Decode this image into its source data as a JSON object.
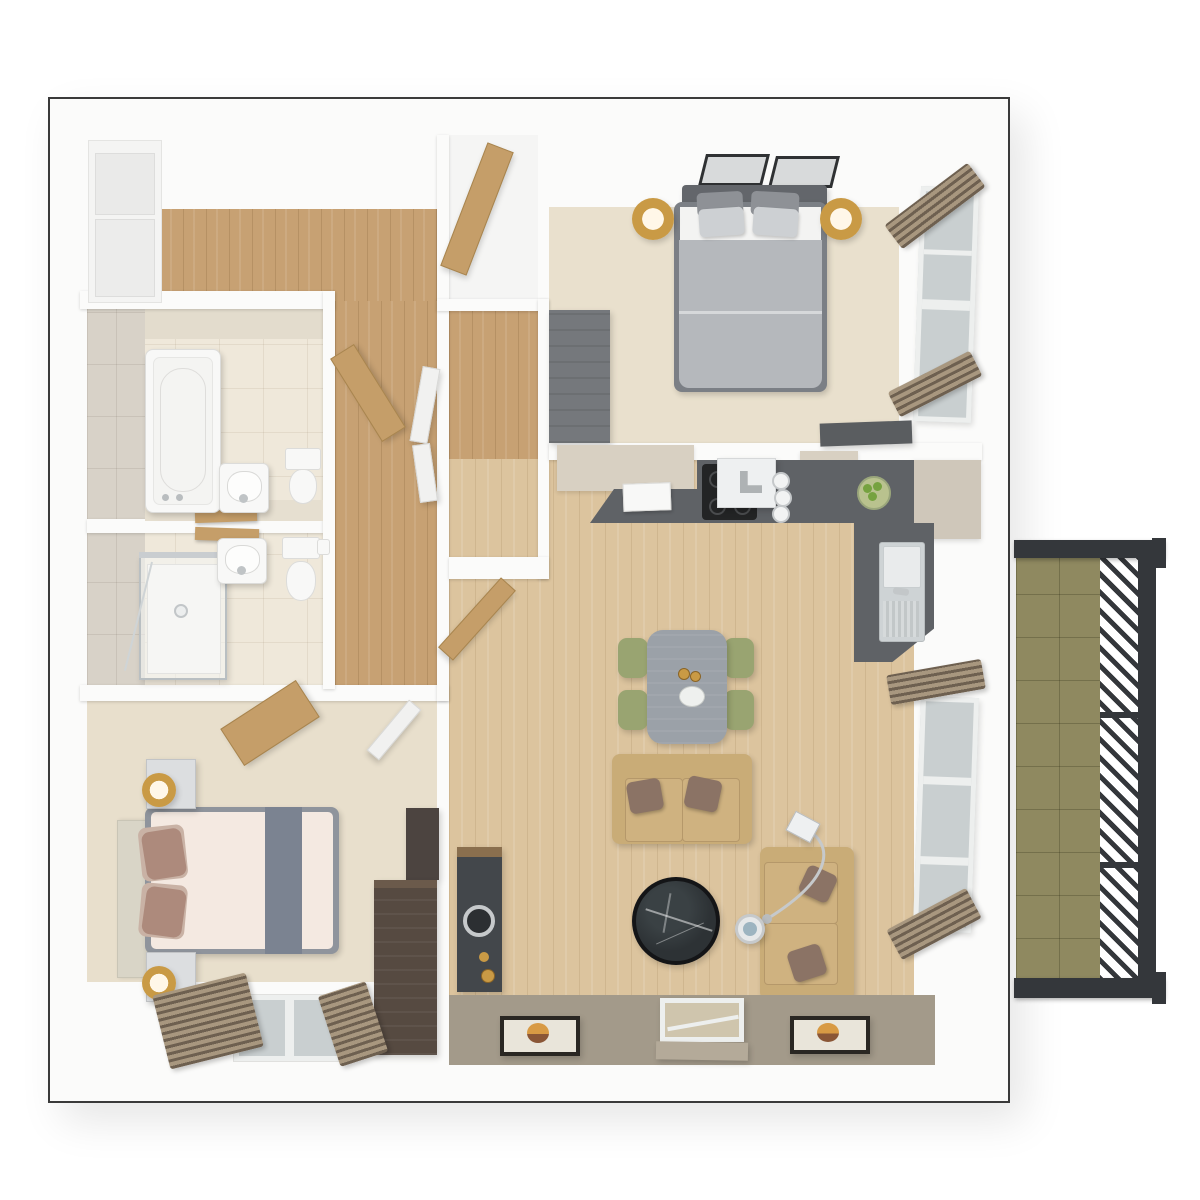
{
  "scene": {
    "type": "architectural-floor-plan-3d-render",
    "view": "top-down-dollhouse",
    "background": "#ffffff",
    "rooms": [
      {
        "id": "entrance-hall",
        "floor": "oak-wood",
        "features": [
          "storage-closet-sliding-doors",
          "internal-doors"
        ]
      },
      {
        "id": "bathroom",
        "floor": "cream-tile",
        "fixtures": [
          "bathtub",
          "washbasin",
          "toilet",
          "wooden-shelf",
          "tiled-wall"
        ]
      },
      {
        "id": "shower-room",
        "floor": "cream-tile",
        "fixtures": [
          "glass-shower-enclosure",
          "washbasin",
          "toilet",
          "wooden-shelf"
        ]
      },
      {
        "id": "bedroom-2",
        "floor": "beige-carpet",
        "furniture": [
          "double-bed-cream-duvet",
          "gray-bed-runner",
          "upholstered-headboard",
          "nightstand-x2",
          "gold-table-lamp-x2",
          "angled-wood-desk",
          "dark-wood-dresser",
          "dark-wood-cabinet",
          "window-pair",
          "louvre-blind-stack-x2",
          "white-door-open"
        ]
      },
      {
        "id": "bedroom-1",
        "floor": "beige-carpet",
        "furniture": [
          "double-bed-gray-duvet",
          "gray-headboard",
          "gray-pillows-x4",
          "gold-floor-lamp-x2",
          "gray-dresser",
          "gray-desk",
          "entry-closet-wood-door",
          "wardrobe-hall",
          "window",
          "louvre-blind-stack-x2",
          "roof-window-x2"
        ]
      },
      {
        "id": "kitchen",
        "furniture": [
          "l-shaped-dark-counter",
          "cream-upper-cabinets",
          "induction-hob",
          "extractor-hood",
          "small-white-appliance",
          "pot-set",
          "fruit-bowl",
          "sink-with-drainer",
          "corner-cabinet"
        ]
      },
      {
        "id": "living-dining",
        "floor": "light-oak-wood",
        "furniture": [
          "dining-table-gray",
          "olive-chair-x4",
          "coffee-set",
          "flower-plate",
          "two-seat-sofa-horizontal",
          "two-seat-sofa-vertical",
          "brown-cushions",
          "round-black-marble-coffee-table",
          "chrome-arc-floor-lamp",
          "round-side-table",
          "dark-tv-unit",
          "speaker-ring",
          "window",
          "louvre-blind-stack-x2",
          "wall-picture-x2",
          "entrance-door-glazed",
          "taupe-entry-band",
          "open-wood-door"
        ]
      },
      {
        "id": "balcony",
        "floor": "olive-green-tile",
        "features": [
          "charcoal-frame",
          "diagonal-slatted-privacy-screen",
          "screen-divider-x2"
        ]
      }
    ]
  },
  "colors": {
    "wall": "#fbfbfa",
    "outline": "#3a3a3a",
    "wood-hall": "#c7a173",
    "wood-living": "#dcc49e",
    "carpet1": "#e9e0cd",
    "carpet2": "#e8dfcc",
    "tile-cream": "#efe8da",
    "tile-wall": "#d8d2c8",
    "tile-top": "#e3dccd",
    "balcony-tile": "#8f8960",
    "balcony-frame": "#34373b",
    "counter-dark": "#5f6266",
    "cabinet-cream": "#d8d0c2",
    "cabinet-cream2": "#cfc7ba",
    "hob": "#232425",
    "sink-steel": "#ced3d5",
    "sofa": "#c9ac77",
    "sofa-cushion": "#cfb280",
    "pillow-brown": "#8b7365",
    "table-gray": "#9ba1a8",
    "chair-olive": "#99a471",
    "coffee-base": "#141517",
    "coffee-marble": "#2d3235",
    "tv-unit": "#43474b",
    "wood-dark": "#564a41",
    "wood-dark2": "#4c4440",
    "wood-top": "#6b5a4b",
    "bed1-duvet": "#b5b8bc",
    "bed1-head": "#63666b",
    "bed1-frame": "#7b7f85",
    "pillow-gray-d": "#8e9196",
    "pillow-gray-l": "#cdd0d3",
    "sheet": "#f3f3f2",
    "bed2-duvet": "#f4e9e1",
    "bed2-runner": "#7b8391",
    "bed2-frame": "#8f949c",
    "headboard2": "#d9d5c7",
    "pillow-mauve": "#ad8a7c",
    "pillow-mauve-l": "#c9b2a5",
    "nightstand": "#dcdee0",
    "lamp-gold": "#c99a45",
    "lamp-glow": "#fff7e8",
    "wood-door": "#c59e69",
    "white-door": "#f1f1f0",
    "glass": "#c9cfd0",
    "frame-white": "#edefee",
    "skylight-frame": "#2f3133",
    "skylight-glass": "#d8dadb",
    "blind-dark": "#6e6050",
    "blind-light": "#a8977f",
    "taupe-band": "#a39a8a",
    "mat-frame": "#2a2723",
    "mat-inner": "#e9e5da",
    "mat-circle1": "#d89a44",
    "mat-circle2": "#8a5636",
    "door-glass": "#cfc5ad",
    "door-flap": "#b4aa99",
    "chrome": "#c6c9cb",
    "fruit-green": "#76a23f",
    "bowl": "#b9c28e",
    "dresser-gray": "#75787c",
    "gray-desk": "#5a5d60",
    "shower-glass": "#b9bfc2",
    "white-fix": "#f8f8f7",
    "fix-edge": "#dcdcda",
    "counter-bath": "#e6dfd0"
  }
}
